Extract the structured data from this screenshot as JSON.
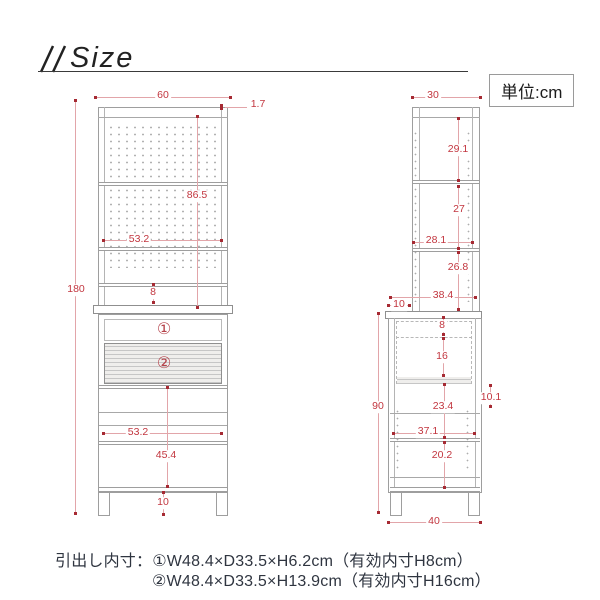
{
  "header": {
    "title": "Size",
    "unit_label": "単位:cm"
  },
  "front_view": {
    "dims": {
      "width_top": "60",
      "top_edge": "1.7",
      "total_height": "180",
      "upper_height": "86.5",
      "upper_inner_width": "53.2",
      "shelf_gap": "8",
      "lower_inner_width": "53.2",
      "lower_inner_height": "45.4",
      "leg_height": "10",
      "drawer1_mark": "①",
      "drawer2_mark": "②"
    }
  },
  "side_view": {
    "dims": {
      "depth_top": "30",
      "upper_space1": "29.1",
      "upper_space2": "27",
      "upper_inner_depth": "28.1",
      "upper_space3": "26.8",
      "lower_inner_depth": "38.4",
      "front_overhang": "10",
      "drawer1_height": "8",
      "drawer2_height": "16",
      "lower_height": "90",
      "back_gap": "10.1",
      "shelf_space1": "23.4",
      "shelf_inner_depth": "37.1",
      "shelf_space2": "20.2",
      "depth_bottom": "40"
    }
  },
  "footer": {
    "line1": "引出し内寸：①W48.4×D33.5×H6.2cm（有効内寸H8cm）",
    "line2": "②W48.4×D33.5×H13.9cm（有効内寸H16cm）"
  }
}
